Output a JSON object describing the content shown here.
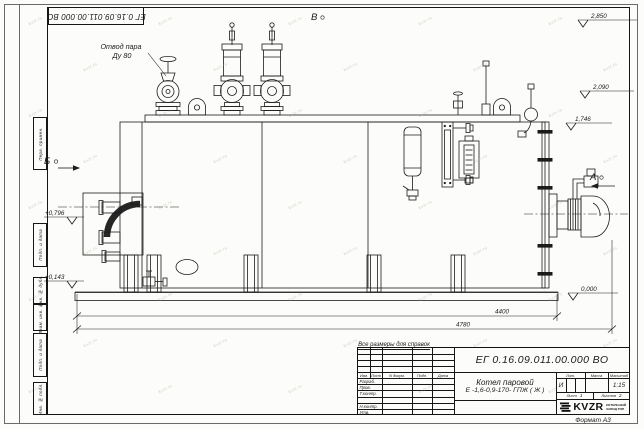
{
  "sheet": {
    "designation": "ЕГ 0.16.09.011.00.000  ВО",
    "format_label": "Формат А3",
    "reference_note": "Все размеры для справок",
    "watermark": "kvzr.ru"
  },
  "margin_stamps": [
    "Перв. примен.",
    "Подп. и дата",
    "Инв. № дубл.",
    "Взам. инв. №",
    "Подп. и дата",
    "Инв. № подл."
  ],
  "view_markers": {
    "left": "Б",
    "top": "В",
    "right": "А"
  },
  "drawing": {
    "steam_outlet_label_line1": "Отвод пара",
    "steam_outlet_label_line2": "Ду 80",
    "elevations": {
      "e2850": "2,850",
      "e2090": "2,090",
      "e1746": "1,746",
      "e0000": "0,000",
      "e0796": "+0,796",
      "e0143": "+0,143"
    },
    "dimensions": {
      "d4400": "4400",
      "d4780": "4780"
    }
  },
  "title_block": {
    "designation": "ЕГ 0.16.09.011.00.000  ВО",
    "product_line1": "Котел паровой",
    "product_line2": "Е -1,6-0,9-170- ГПЖ ( Ж )",
    "columns": {
      "izm": "Изм.",
      "list": "Лист",
      "doc": "N докум.",
      "podp": "Подп.",
      "data": "Дата"
    },
    "rows": {
      "razrab": "Разраб.",
      "prov": "Пров.",
      "tkontr": "Т.контр.",
      "nkontr": "Н.контр.",
      "utv": "Утв."
    },
    "lit_label": "Лит.",
    "mass_label": "Масса",
    "scale_label": "Масштаб",
    "lit_value": "И",
    "scale_value": "1:15",
    "sheet_label": "Лист",
    "sheet_value": "1",
    "sheets_label": "Листов",
    "sheets_value": "2",
    "logo_text": "KVZR",
    "company_line1": "КОТЕЛЬНЫЙ",
    "company_line2": "ЗАВОД РЭП"
  }
}
